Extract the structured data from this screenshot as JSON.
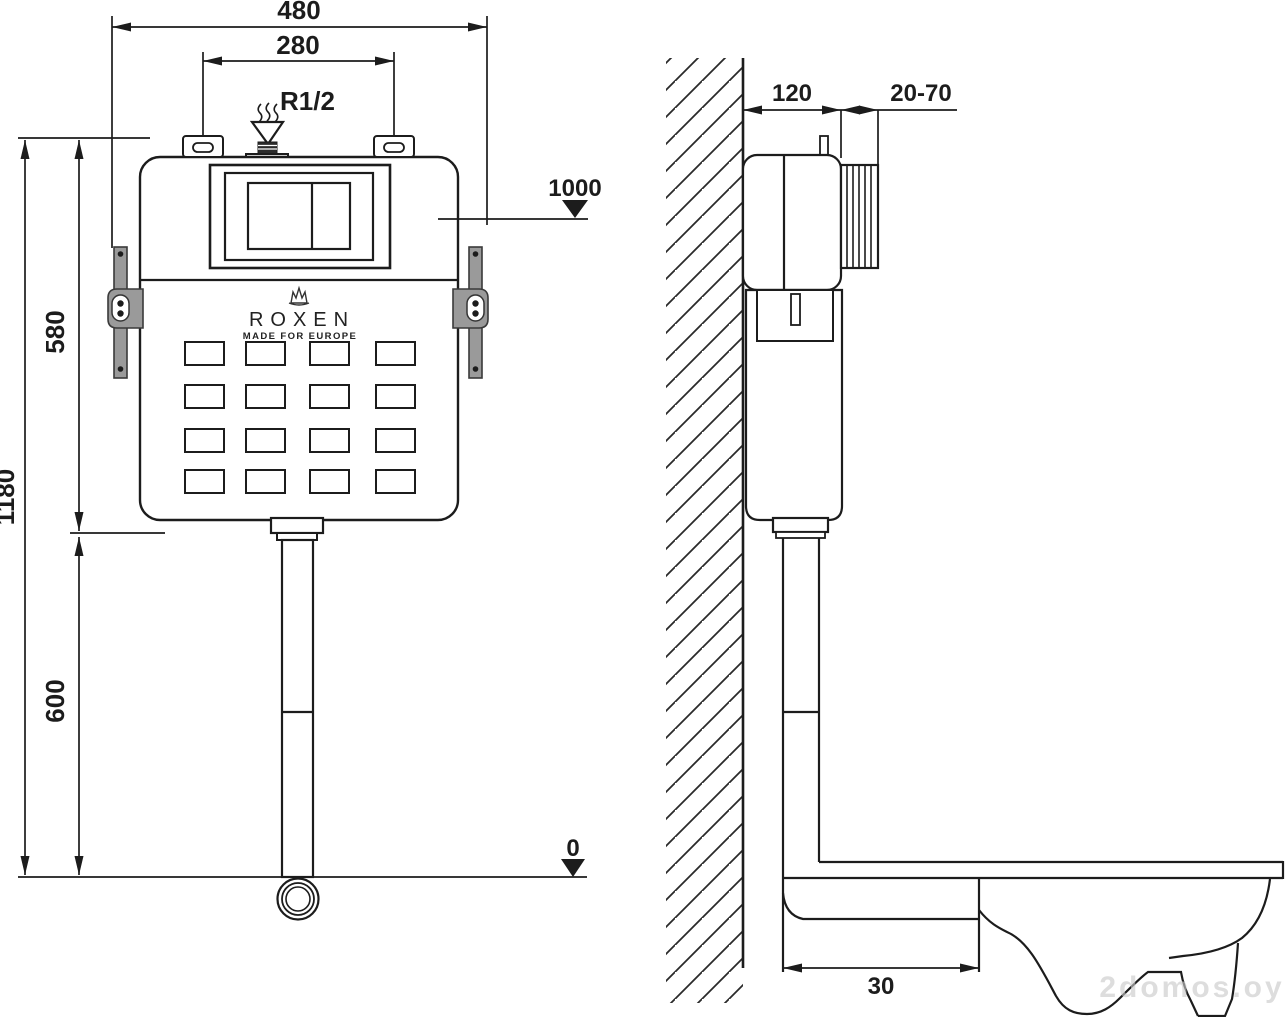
{
  "front_view": {
    "dim_overall_width": "480",
    "dim_mount_spacing": "280",
    "inlet_thread": "R1/2",
    "level_flush_plate": "1000",
    "dim_total_height": "1180",
    "dim_tank_height": "580",
    "dim_outlet_drop": "600",
    "level_floor": "0",
    "brand": {
      "name": "ROXEN",
      "tagline": "MADE FOR EUROPE"
    }
  },
  "side_view": {
    "dim_depth": "120",
    "dim_plate_adjustment": "20-70",
    "dim_outlet_offset": "30"
  },
  "watermark": "2domos.oy",
  "colors": {
    "line": "#1c1c1c",
    "bracket_fill": "#9a9a9a",
    "watermark": "#c9c9c9"
  }
}
